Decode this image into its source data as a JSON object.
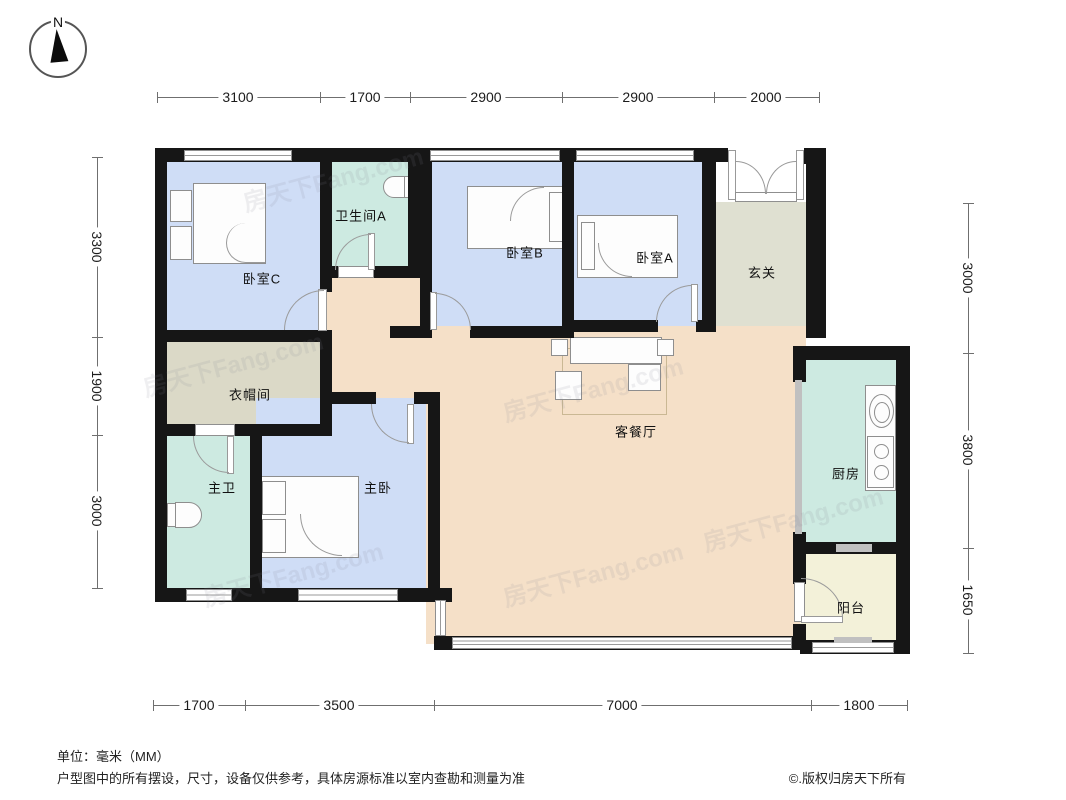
{
  "compass": {
    "north_label": "N"
  },
  "dimensions": {
    "unit_note": "单位：毫米（MM）",
    "top": [
      "3100",
      "1700",
      "2900",
      "2900",
      "2000"
    ],
    "left": [
      "3300",
      "1900",
      "3000"
    ],
    "right": [
      "3000",
      "3800",
      "1650"
    ],
    "bottom": [
      "1700",
      "3500",
      "7000",
      "1800"
    ]
  },
  "rooms": [
    {
      "id": "bedroom-c",
      "label": "卧室C"
    },
    {
      "id": "bathroom-a",
      "label": "卫生间A"
    },
    {
      "id": "bedroom-b",
      "label": "卧室B"
    },
    {
      "id": "bedroom-a",
      "label": "卧室A"
    },
    {
      "id": "entrance",
      "label": "玄关"
    },
    {
      "id": "cloakroom",
      "label": "衣帽间"
    },
    {
      "id": "master-bath",
      "label": "主卫"
    },
    {
      "id": "master-bedroom",
      "label": "主卧"
    },
    {
      "id": "living-dining",
      "label": "客餐厅"
    },
    {
      "id": "kitchen",
      "label": "厨房"
    },
    {
      "id": "balcony",
      "label": "阳台"
    }
  ],
  "colors": {
    "bedroom": "#cfddf6",
    "bathroom": "#cdeae1",
    "living": "#f5e0c8",
    "entrance": "#dfe0d1",
    "cloakroom": "#dbd9c7",
    "kitchen": "#cdeae1",
    "balcony": "#f3f1d9",
    "wall": "#161616"
  },
  "watermark": {
    "text": "房天下Fang.com"
  },
  "footer": {
    "unit": "单位：毫米（MM）",
    "disclaimer": "户型图中的所有摆设，尺寸，设备仅供参考，具体房源标准以室内查勘和测量为准",
    "copyright": "©.版权归房天下所有"
  }
}
